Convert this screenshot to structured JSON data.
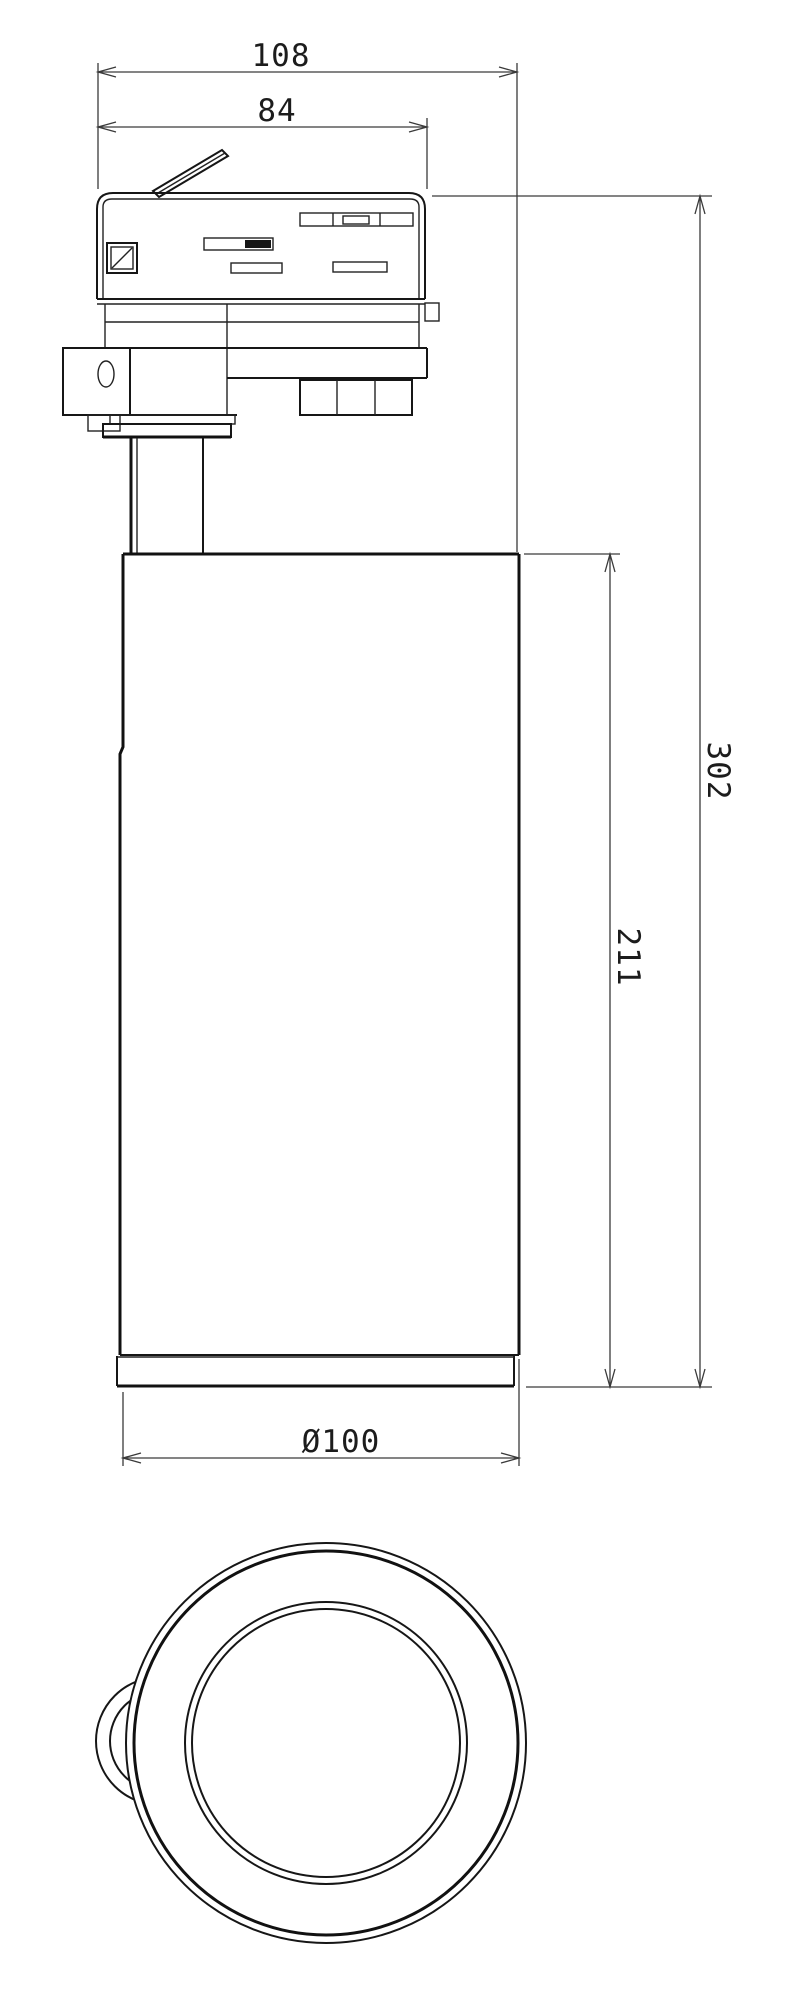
{
  "drawing": {
    "background": "#ffffff",
    "line_color": "#161616",
    "dimension_color": "#3a3a3a",
    "dimensions": {
      "overall_width": "108",
      "adapter_width": "84",
      "overall_height": "302",
      "body_height": "211",
      "diameter": "Ø100"
    }
  }
}
